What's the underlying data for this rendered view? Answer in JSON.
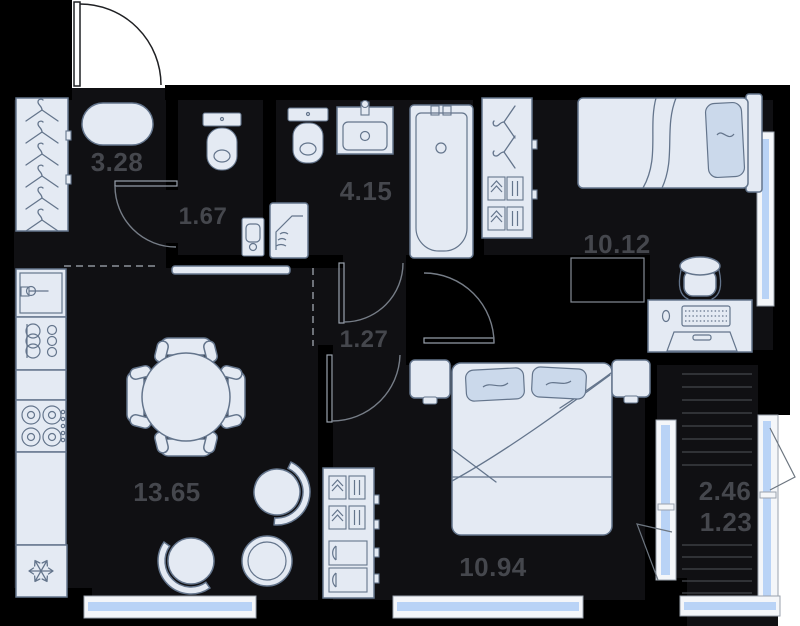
{
  "title": "Apartment floor plan",
  "rooms": {
    "hallway": {
      "area": "3.28"
    },
    "wc": {
      "area": "1.67"
    },
    "bathroom": {
      "area": "4.15"
    },
    "bedroom_small": {
      "area": "10.12"
    },
    "corridor": {
      "area": "1.27"
    },
    "living_kitchen": {
      "area": "13.65"
    },
    "bedroom_master": {
      "area": "10.94"
    },
    "balcony": {
      "area_full": "2.46",
      "area_counted": "1.23"
    }
  },
  "colors": {
    "wall": "#000000",
    "floor": "#101013",
    "outside": "#ffffff",
    "furniture_fill": "#e4eaf3",
    "furniture_stroke": "#64758c",
    "pillow_fill": "#cbd9eb",
    "window_glass": "#b9d3f6",
    "label_text": "#45474d"
  },
  "icons": {
    "hanger-icon": "clothes hanger",
    "toilet-icon": "toilet top view",
    "sink-icon": "washbasin vanity",
    "bathtub-icon": "bathtub top view",
    "washing-machine-icon": "washer with laundry",
    "fridge-icon": "snowflake",
    "stove-icon": "four burner hob",
    "single-bed-icon": "single bed with pillow",
    "double-bed-icon": "double bed with two pillows",
    "desk-icon": "desk with keyboard and chair",
    "dining-table-icon": "round table with four chairs",
    "armchair-icon": "round armchair",
    "side-table-icon": "round side table",
    "balcony-decking-icon": "striped balcony slab"
  }
}
